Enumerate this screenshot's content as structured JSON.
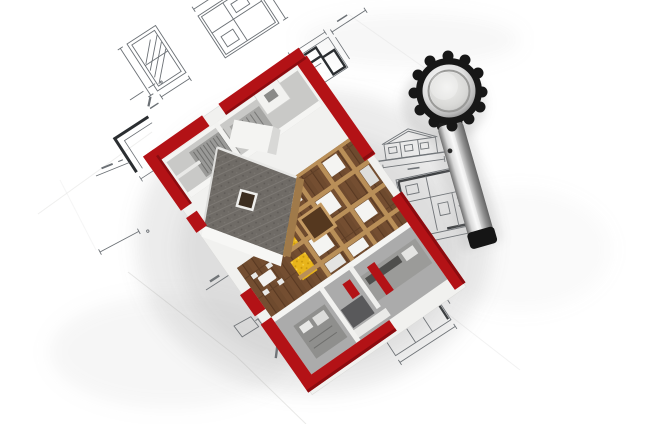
{
  "image": {
    "subject": "3d-house-model-on-architectural-blueprints-with-magnifying-glass",
    "style": "photorealistic-render",
    "text_content": "none-legible"
  },
  "colors": {
    "background": "#ffffff",
    "blueprint_ink": "#6b7075",
    "blueprint_ink_dark": "#2b2e31",
    "sheet_edge": "#d8d8d6",
    "red_wall": "#b31216",
    "red_wall_dark": "#8c0b0f",
    "roof_gray": "#6f6b66",
    "roof_speck_light": "#7d7974",
    "roof_speck_dark": "#5e5a56",
    "wood_dark": "#6e4a2e",
    "wood_plank_line": "#593922",
    "wood_light_beam": "#b98f58",
    "insulation_yellow": "#e8b51b",
    "insulation_dot": "#c8960d",
    "white_wall": "#f4f4f2",
    "interior_gray": "#ababab",
    "interior_gray_light": "#c9c9c7",
    "fixture_gray": "#8f8f8d",
    "appliance_dark": "#59595b",
    "glass_rim": "#171717",
    "cap_black": "#151515",
    "shadow": "#8a8a8a"
  },
  "objects": {
    "house_model": {
      "position": "center",
      "rotation_deg": -35,
      "parts": [
        "red-perimeter-walls",
        "tiled-roof-slope",
        "white-gable",
        "chimney",
        "stair-rooms",
        "wood-floor",
        "wood-beam-grid",
        "insulation-patches",
        "stairwell-opening",
        "dining-set",
        "kitchen-room",
        "bathroom-room"
      ]
    },
    "magnifying_glass": {
      "position": "top-right",
      "parts": [
        "scalloped-bezel",
        "metal-ring",
        "lens",
        "metal-handle",
        "screw-dot",
        "end-cap"
      ]
    },
    "blueprints": {
      "drawings": [
        "window-section-detail",
        "small-floor-plan",
        "dark-floor-plan",
        "house-elevation",
        "large-floor-plan",
        "stair-ladder-detail",
        "floor-plan-fragment",
        "corner-detail",
        "small-quad-sketch"
      ],
      "annotations": "dimension-lines-and-tick-marks"
    }
  }
}
